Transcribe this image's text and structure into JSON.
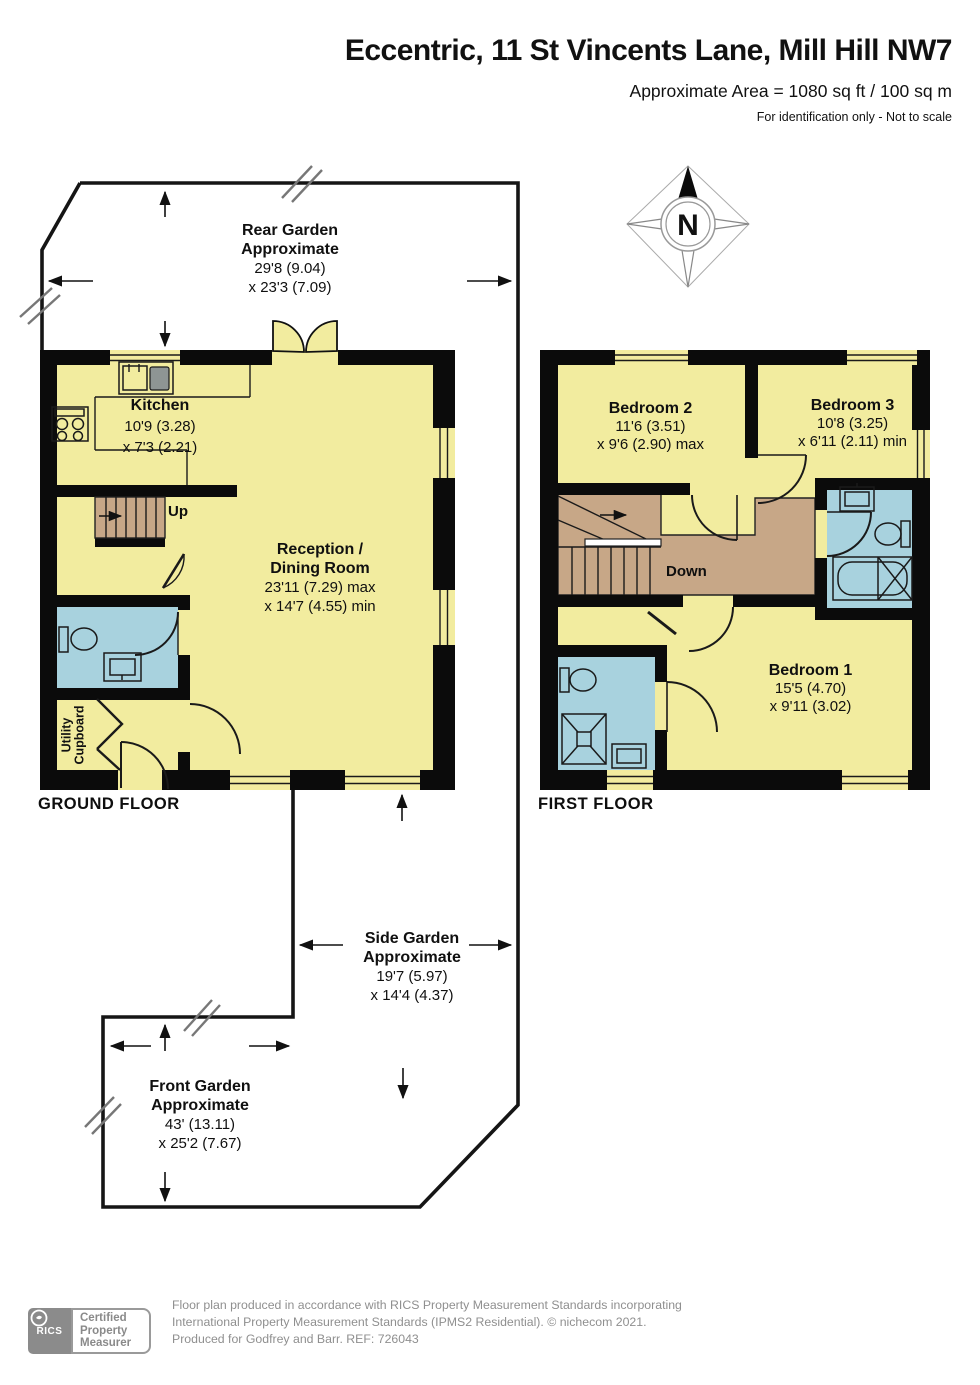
{
  "header": {
    "title": "Eccentric, 11 St Vincents Lane, Mill Hill NW7",
    "area_line": "Approximate Area = 1080 sq ft / 100 sq m",
    "note_line": "For identification only - Not to scale"
  },
  "compass": {
    "north_label": "N"
  },
  "gardens": {
    "rear": {
      "name": "Rear Garden",
      "qualifier": "Approximate",
      "dim1": "29'8 (9.04)",
      "dim2": "x 23'3 (7.09)"
    },
    "side": {
      "name": "Side Garden",
      "qualifier": "Approximate",
      "dim1": "19'7 (5.97)",
      "dim2": "x 14'4 (4.37)"
    },
    "front": {
      "name": "Front Garden",
      "qualifier": "Approximate",
      "dim1": "43' (13.11)",
      "dim2": "x 25'2 (7.67)"
    }
  },
  "ground_floor": {
    "label": "GROUND FLOOR",
    "kitchen": {
      "name": "Kitchen",
      "dim1": "10'9 (3.28)",
      "dim2": "x 7'3 (2.21)"
    },
    "reception": {
      "name_line1": "Reception /",
      "name_line2": "Dining Room",
      "dim1": "23'11 (7.29) max",
      "dim2": "x 14'7 (4.55) min"
    },
    "utility": {
      "line1": "Utility",
      "line2": "Cupboard"
    },
    "stairs_label": "Up"
  },
  "first_floor": {
    "label": "FIRST FLOOR",
    "bedroom1": {
      "name": "Bedroom 1",
      "dim1": "15'5 (4.70)",
      "dim2": "x 9'11 (3.02)"
    },
    "bedroom2": {
      "name": "Bedroom 2",
      "dim1": "11'6 (3.51)",
      "dim2": "x 9'6 (2.90) max"
    },
    "bedroom3": {
      "name": "Bedroom 3",
      "dim1": "10'8 (3.25)",
      "dim2": "x 6'11 (2.11) min"
    },
    "stairs_label": "Down"
  },
  "footer": {
    "rics": "RICS",
    "badge_line1": "Certified",
    "badge_line2": "Property",
    "badge_line3": "Measurer",
    "line1": "Floor plan produced in accordance with RICS Property Measurement Standards incorporating",
    "line2": "International Property Measurement Standards (IPMS2 Residential).   © nichecom 2021.",
    "line3": "Produced for Godfrey and Barr.    REF:  726043"
  },
  "colors": {
    "room_yellow": "#F2EC9F",
    "wet_room_blue": "#A8D2DE",
    "stairs_brown": "#C7A787",
    "wall_black": "#0B0B0B",
    "footer_grey": "#8B8B8B"
  }
}
